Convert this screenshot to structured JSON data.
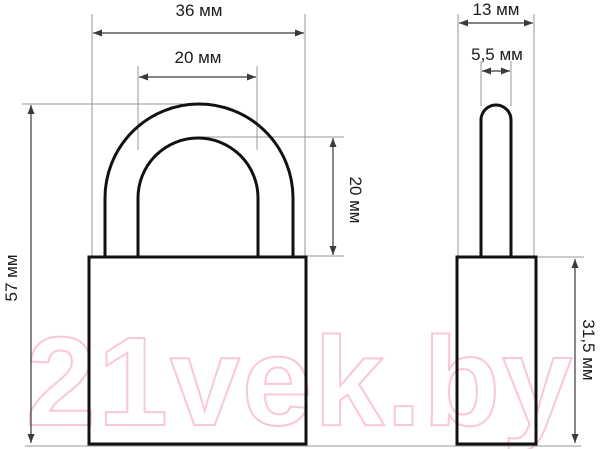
{
  "watermark": {
    "text": "21vek.by",
    "color": "#f9c8d5"
  },
  "colors": {
    "outline": "#121212",
    "dimension_line": "#3a3a3a",
    "extension_line": "#979797",
    "label_text": "#1c1c1c",
    "background": "#ffffff"
  },
  "drawing": {
    "subject": "padlock",
    "unit": "мм",
    "views": {
      "front": {
        "dimensions": {
          "body_width": "36 мм",
          "shackle_inner_width": "20 мм",
          "total_height": "57 мм",
          "shackle_height": "20 мм"
        }
      },
      "side": {
        "dimensions": {
          "body_depth": "13 мм",
          "shackle_diameter": "5,5 мм",
          "body_height": "31,5 мм"
        }
      }
    }
  }
}
